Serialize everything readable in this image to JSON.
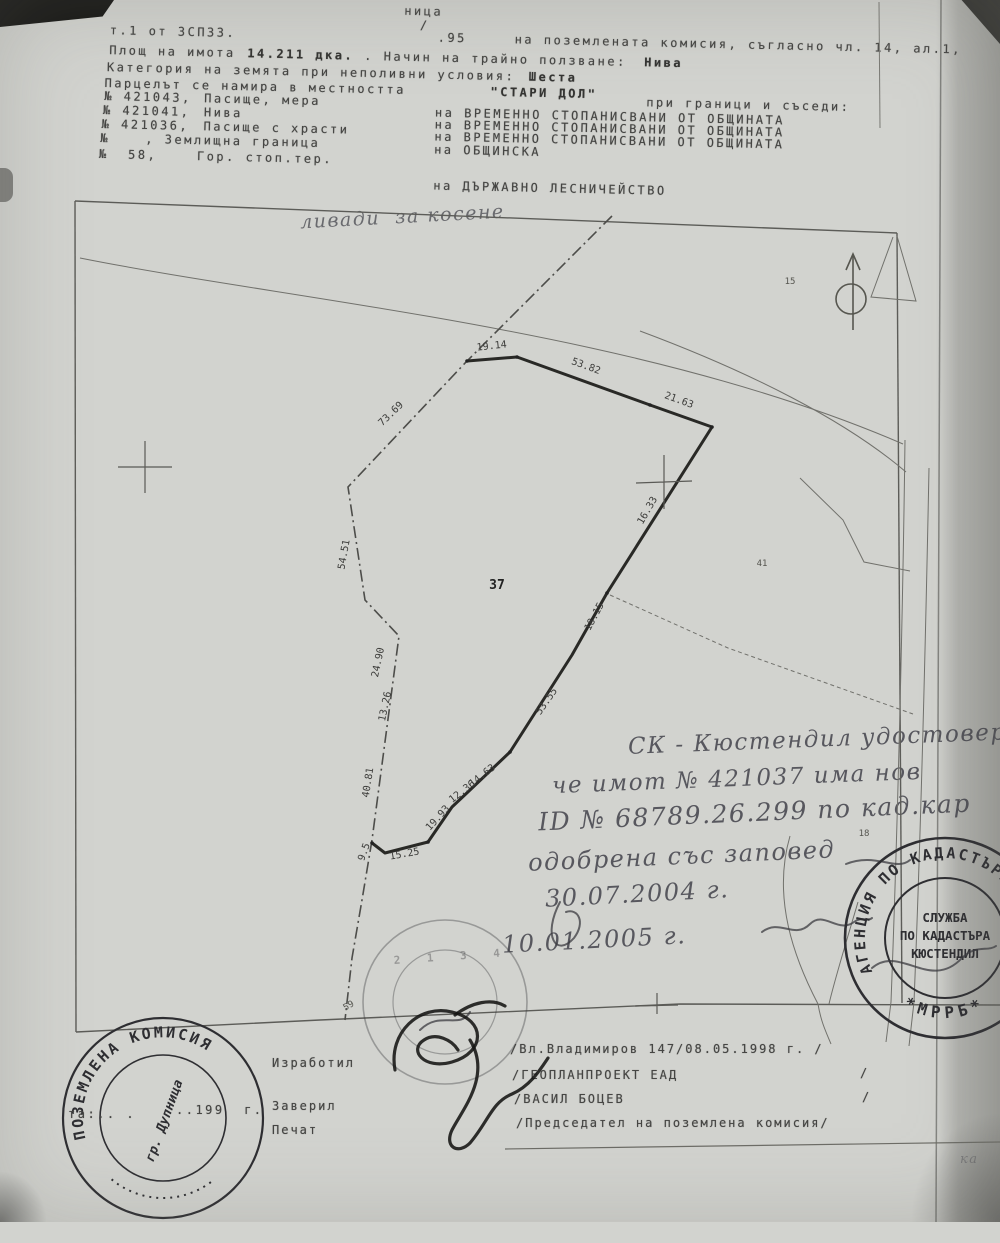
{
  "scan": {
    "top_fragment": "ница",
    "header": {
      "l1_left": "т.1 от ЗСПЗЗ.",
      "l1_slash": "/",
      "l1_num": ".95",
      "l1_right": "на поземлената комисия, съгласно чл. 14, ал.1,",
      "l2_label": "Площ на имота",
      "l2_area": "14.211 дка.",
      "l2_mid": ". Начин на трайно ползване:",
      "l2_use": "Нива",
      "l3_label": "Категория на земята при неполивни условия:",
      "l3_value": "Шеста",
      "l4_label": "Парцелът се намира в местността",
      "l4_place": "\"СТАРИ ДОЛ\"",
      "l4_right": "при граници и съседи:",
      "neighbors": [
        {
          "num": "№ 421043,",
          "desc": "Пасище, мера",
          "owner": "на ВРЕМЕННО СТОПАНИСВАНИ ОТ ОБЩИНАТА"
        },
        {
          "num": "№ 421041,",
          "desc": "Нива",
          "owner": "на ВРЕМЕННО СТОПАНИСВАНИ ОТ ОБЩИНАТА"
        },
        {
          "num": "№ 421036,",
          "desc": "Пасище с храсти",
          "owner": "на ВРЕМЕННО СТОПАНИСВАНИ ОТ ОБЩИНАТА"
        },
        {
          "num": "№",
          "desc": ", Землищна граница",
          "owner": "на ОБЩИНСКА"
        },
        {
          "num": "№  58,",
          "desc": "Гор. стоп.тер.",
          "owner": "на ДЪРЖАВНО ЛЕСНИЧЕЙСТВО"
        }
      ]
    },
    "map": {
      "hand_label": "ливади  за косене",
      "parcel": "37",
      "labels": {
        "p41": "41",
        "p15": "15",
        "p18": "18",
        "p59": "59"
      },
      "measurements": [
        "19.14",
        "53.82",
        "21.63",
        "73.69",
        "16.33",
        "18.15",
        "53.55",
        "14.63",
        "12.36",
        "19.93",
        "15.25",
        "9.5",
        "54.51",
        "24.90",
        "13.26",
        "40.81"
      ],
      "stamp_faint_digits": "2 1 3 4"
    },
    "annotation": {
      "lines": [
        "СК - Кюстендил удостоверяв",
        "че имот № 421037 има нов",
        "ID № 68789.26.299 по кад.кар",
        "одобрена със заповед",
        "30.07.2004 г.",
        "10.01.2005 г."
      ]
    },
    "stamps": {
      "right": {
        "ring_top": "АГЕНЦИЯ ПО КАДАСТЪРА",
        "ring_bottom": "*МРРБ*",
        "inner1": "СЛУЖБА",
        "inner2": "ПО КАДАСТЪРА",
        "inner3": "КЮСТЕНДИЛ"
      },
      "left": {
        "ring": "ПОЗЕМЛЕНА КОМИСИЯ",
        "inner_city": "гр. Дупница",
        "typed1": "та:.. .",
        "typed2": "..199  г."
      }
    },
    "footer": {
      "made": "Изработил",
      "certified": "Заверил",
      "seal": "Печат",
      "line1": "/Вл.Владимиров 147/08.05.1998 г. /",
      "line2": "/ГЕОПЛАНПРОЕКТ ЕАД",
      "line3": "/ВАСИЛ БОЦЕВ",
      "line4": "/Председател на поземлена комисия/",
      "slash": "/"
    },
    "margin_note": "ка"
  }
}
